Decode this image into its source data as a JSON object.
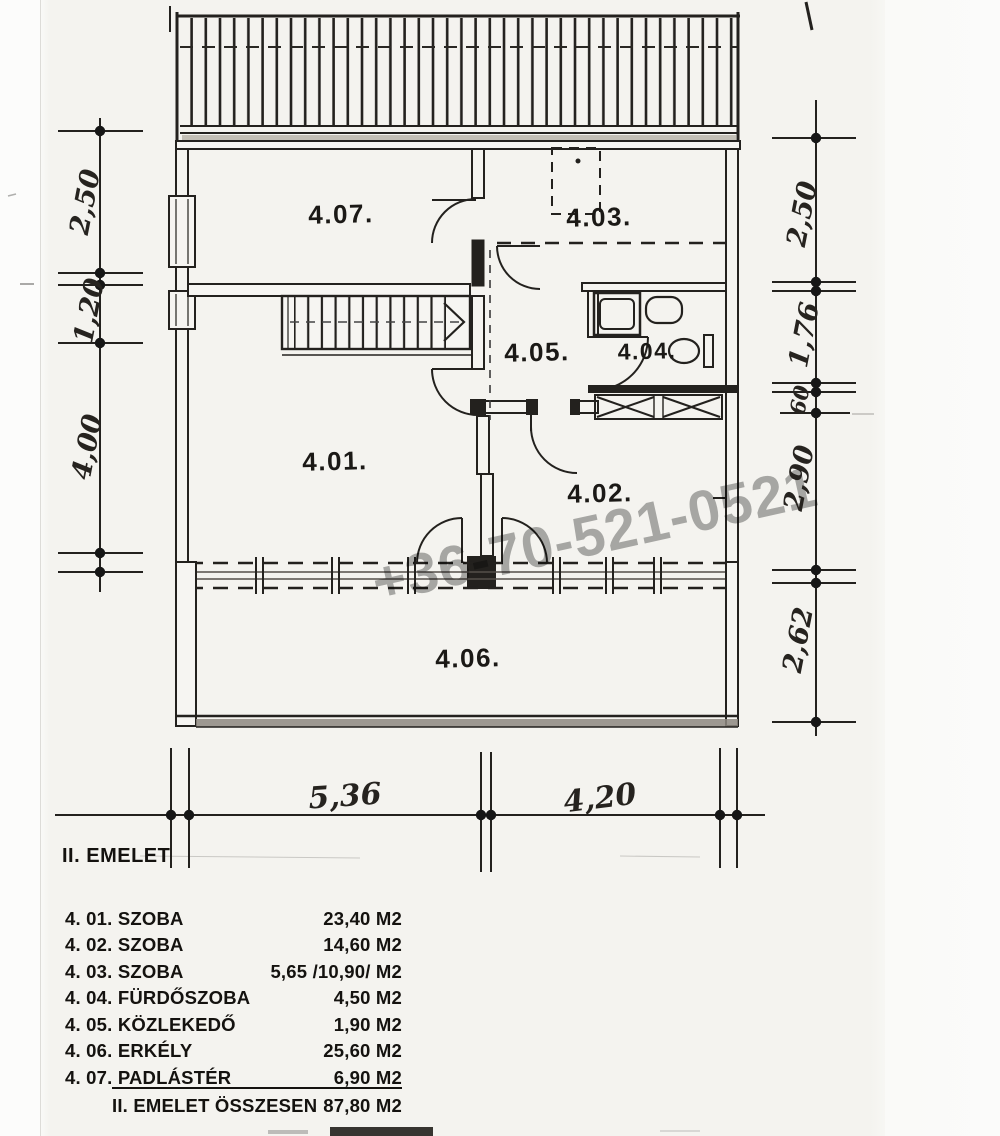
{
  "page": {
    "title": "II. EMELET",
    "watermark": "+36-70-521-0521"
  },
  "plan": {
    "room_labels": [
      {
        "id": "4-07",
        "text": "4.07."
      },
      {
        "id": "4-03",
        "text": "4.03."
      },
      {
        "id": "4-05",
        "text": "4.05."
      },
      {
        "id": "4-04",
        "text": "4.04."
      },
      {
        "id": "4-01",
        "text": "4.01."
      },
      {
        "id": "4-02",
        "text": "4.02."
      },
      {
        "id": "4-06",
        "text": "4.06."
      }
    ],
    "dimensions": {
      "left": [
        "2,50",
        "1,20",
        "4,00"
      ],
      "right": [
        "2,50",
        "1,76",
        "60",
        "2,90",
        "2,62"
      ],
      "bottom": [
        "5,36",
        "4,20"
      ]
    }
  },
  "legend": {
    "rows": [
      {
        "label": "4. 01. SZOBA",
        "area": "23,40 M2"
      },
      {
        "label": "4. 02. SZOBA",
        "area": "14,60 M2"
      },
      {
        "label": "4. 03. SZOBA",
        "area": "5,65 /10,90/ M2"
      },
      {
        "label": "4. 04. FÜRDŐSZOBA",
        "area": "4,50 M2"
      },
      {
        "label": "4. 05. KÖZLEKEDŐ",
        "area": "1,90 M2"
      },
      {
        "label": "4. 06. ERKÉLY",
        "area": "25,60 M2"
      },
      {
        "label": "4. 07. PADLÁSTÉR",
        "area": "6,90 M2"
      }
    ],
    "total": {
      "label": "II. EMELET ÖSSZESEN",
      "area": "87,80 M2"
    }
  }
}
